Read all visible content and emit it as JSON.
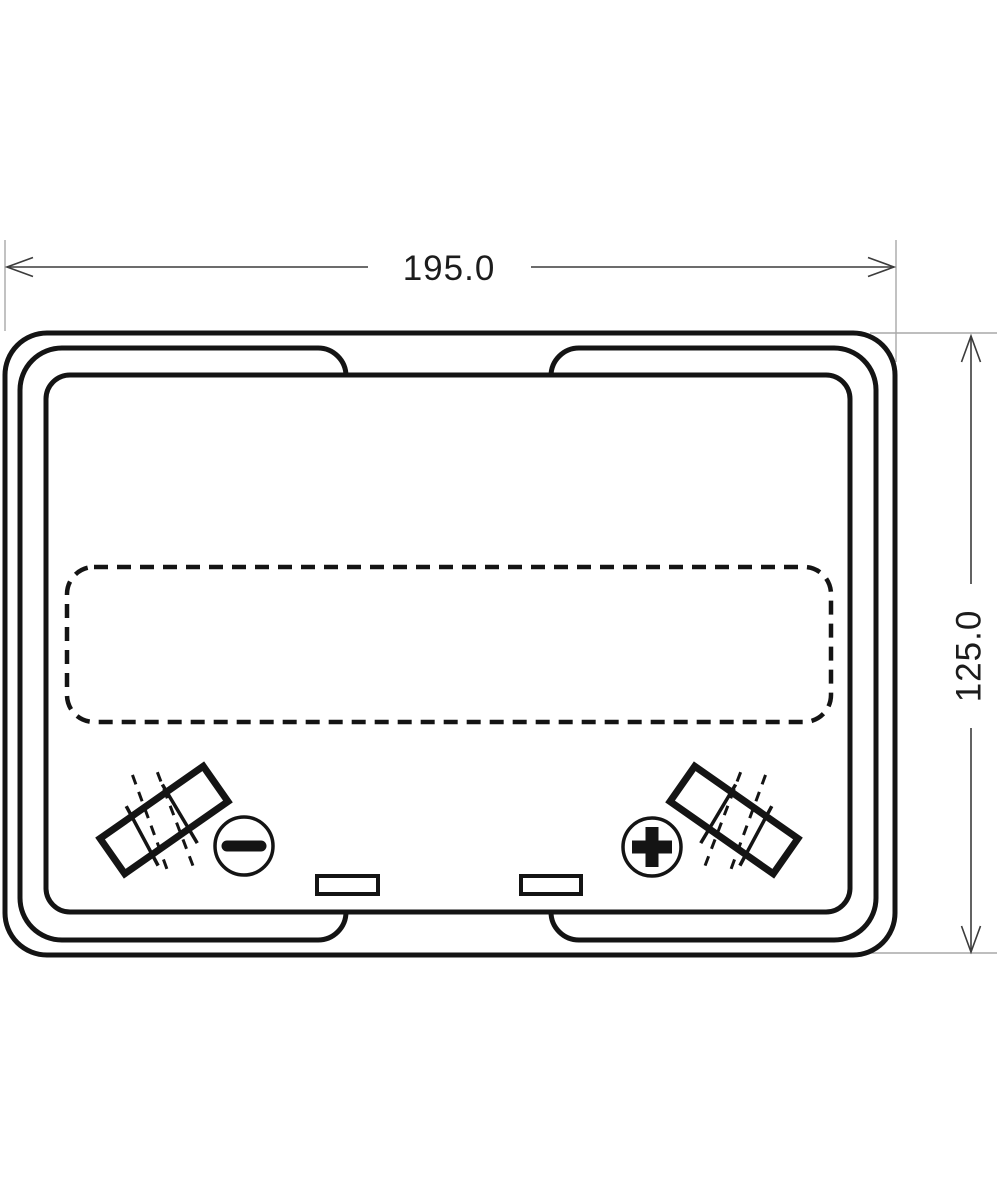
{
  "diagram": {
    "type": "technical-drawing",
    "subject": "battery-top-view",
    "dimensions": {
      "width_label": "195.0",
      "height_label": "125.0"
    },
    "terminals": {
      "negative": {
        "icon": "minus-icon",
        "symbol": "−",
        "position": "bottom-left"
      },
      "positive": {
        "icon": "plus-icon",
        "symbol": "+",
        "position": "bottom-right"
      }
    },
    "colors": {
      "background": "#ffffff",
      "outline": "#141414",
      "dimension_line": "#3c3c3c",
      "extension_line": "#a8a8a8",
      "label_text": "#1c1c1c"
    }
  }
}
